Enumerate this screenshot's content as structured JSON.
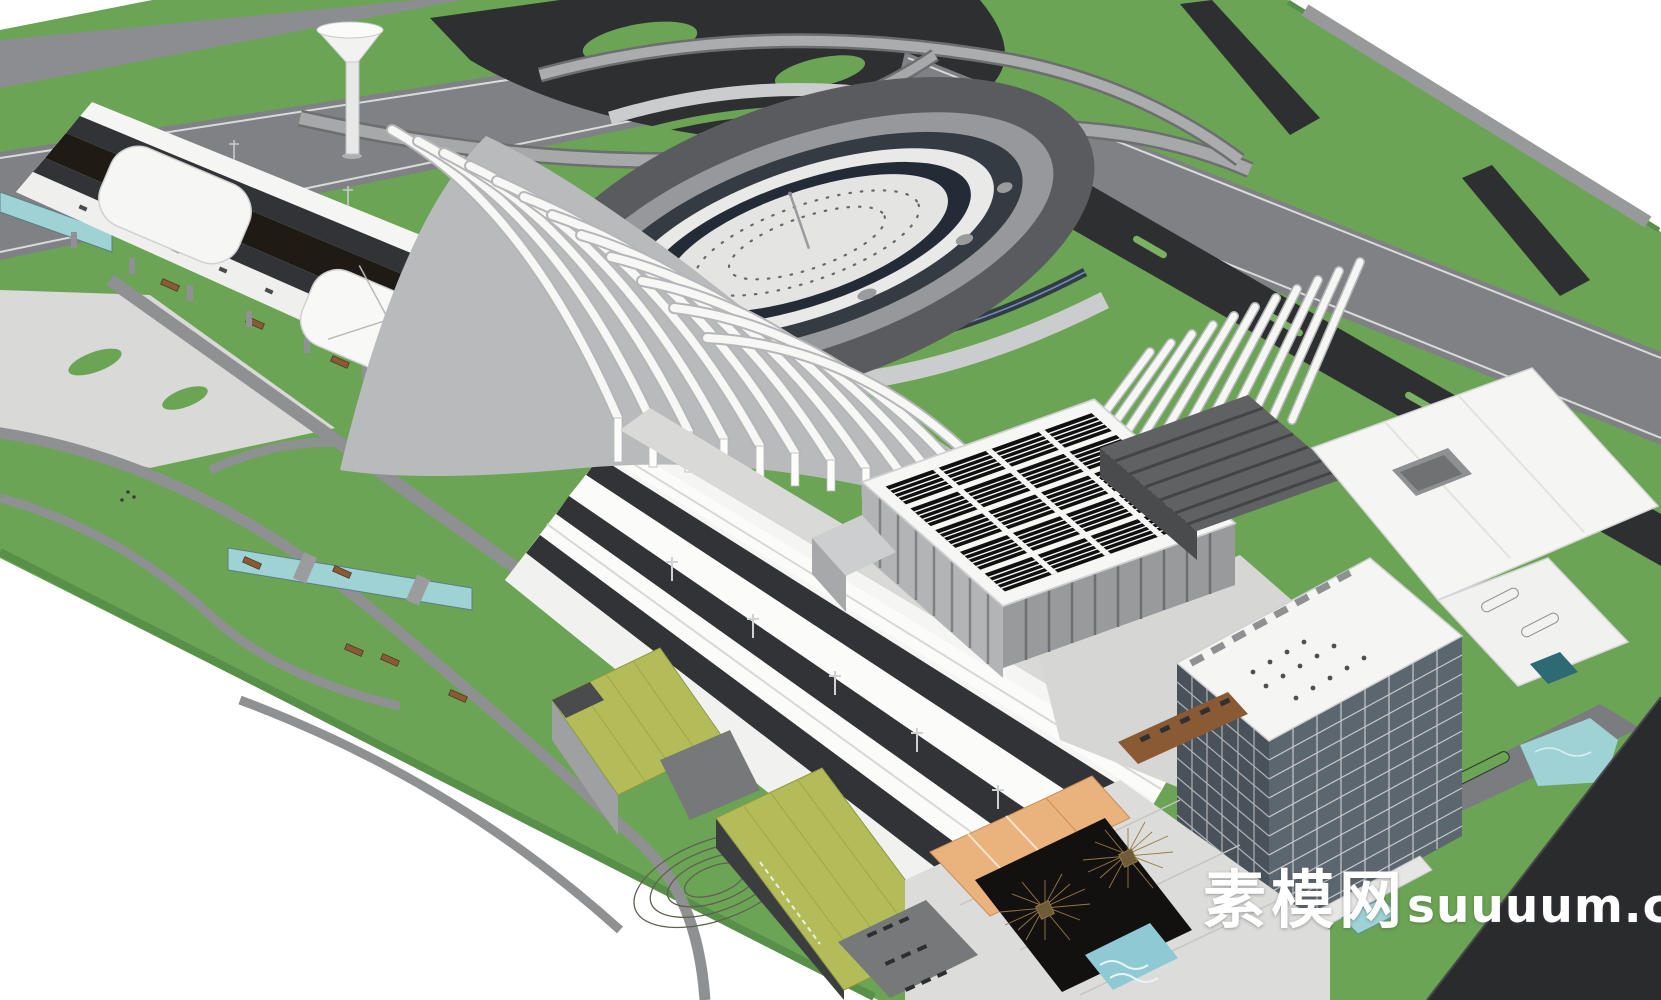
{
  "watermark": {
    "cn": "素模网",
    "en": "suuuum.com"
  },
  "palette": {
    "grass": "#6BA454",
    "grassLight": "#7BB162",
    "road": "#8C8D90",
    "highway": "#7F8184",
    "asphalt": "#2E2F31",
    "pavingDark": "#5A5B5E",
    "pavingLight": "#D9D9D7",
    "white": "#F5F5F3",
    "shade": "#C7C8CA",
    "track": "#323336",
    "truss": "#1F1A14",
    "panel": "#101010",
    "greenRoof": "#B4BC5A",
    "water": "#9ED2D4",
    "waterDark": "#232B36",
    "orange": "#EAB37E",
    "glass": "#49525B",
    "glassLight": "#5C666F",
    "wood": "#8A5A35",
    "darkWedge": "#2A2B2D",
    "watermarkColor": "#FFFFFF"
  }
}
